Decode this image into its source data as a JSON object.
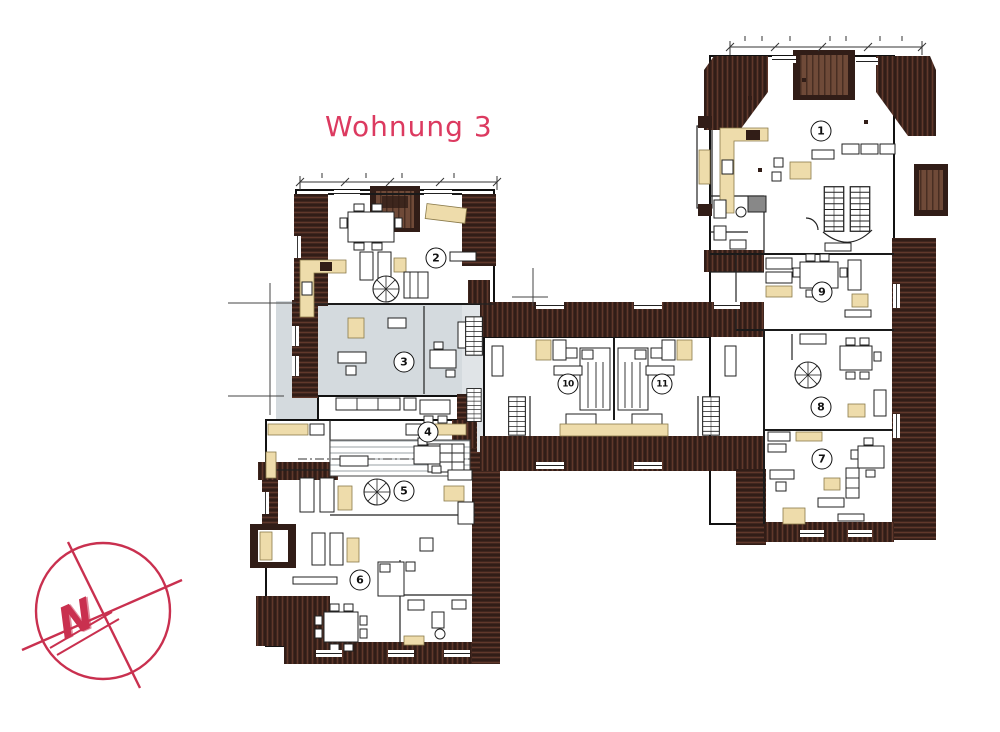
{
  "title": "Wohnung 3",
  "room_labels": [
    "1",
    "2",
    "3",
    "4",
    "5",
    "6",
    "7",
    "8",
    "9",
    "10",
    "11"
  ],
  "compass_label": "N",
  "colors": {
    "accent": "#dc3a60",
    "compass": "#c9304f",
    "wall": "#311d17",
    "wall_hatch": "#7a4636",
    "dormer": "#6f4a38",
    "beige": "#eedcab",
    "highlight": "#d4dade"
  }
}
